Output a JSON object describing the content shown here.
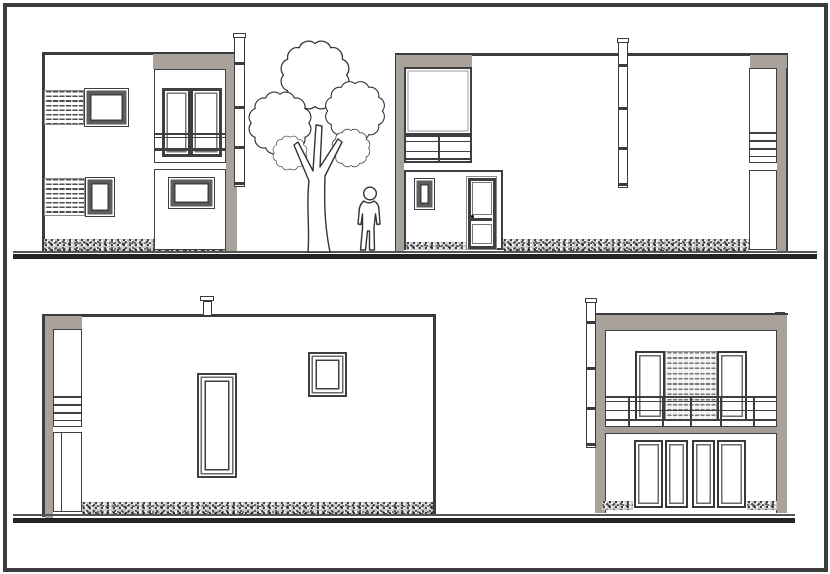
{
  "sheet": {
    "type": "architectural elevation drawing",
    "text_content": "none visible",
    "views": {
      "top_left": "two-storey facade: two louvered windows, balcony double window, wall chimney",
      "top_right": "long facade: corner glazing with balustrade, entry wing with door and small window, chimney",
      "bottom_left": "long side facade: corner glazing strip, tall narrow window, small square window, roof chimney",
      "bottom_right": "two-storey facade: balcony railing, central louvered band between two windows, four glazed door panels, wall chimney"
    },
    "entourage": [
      "deciduous tree",
      "standing person"
    ]
  },
  "colors": {
    "paper": "#ffffff",
    "line": "#3c3c3c",
    "frame": "#3f3f3f",
    "wall_gray": "#a8a29b",
    "ground": "#242424",
    "stipple_bg": "#c8c8c8"
  }
}
